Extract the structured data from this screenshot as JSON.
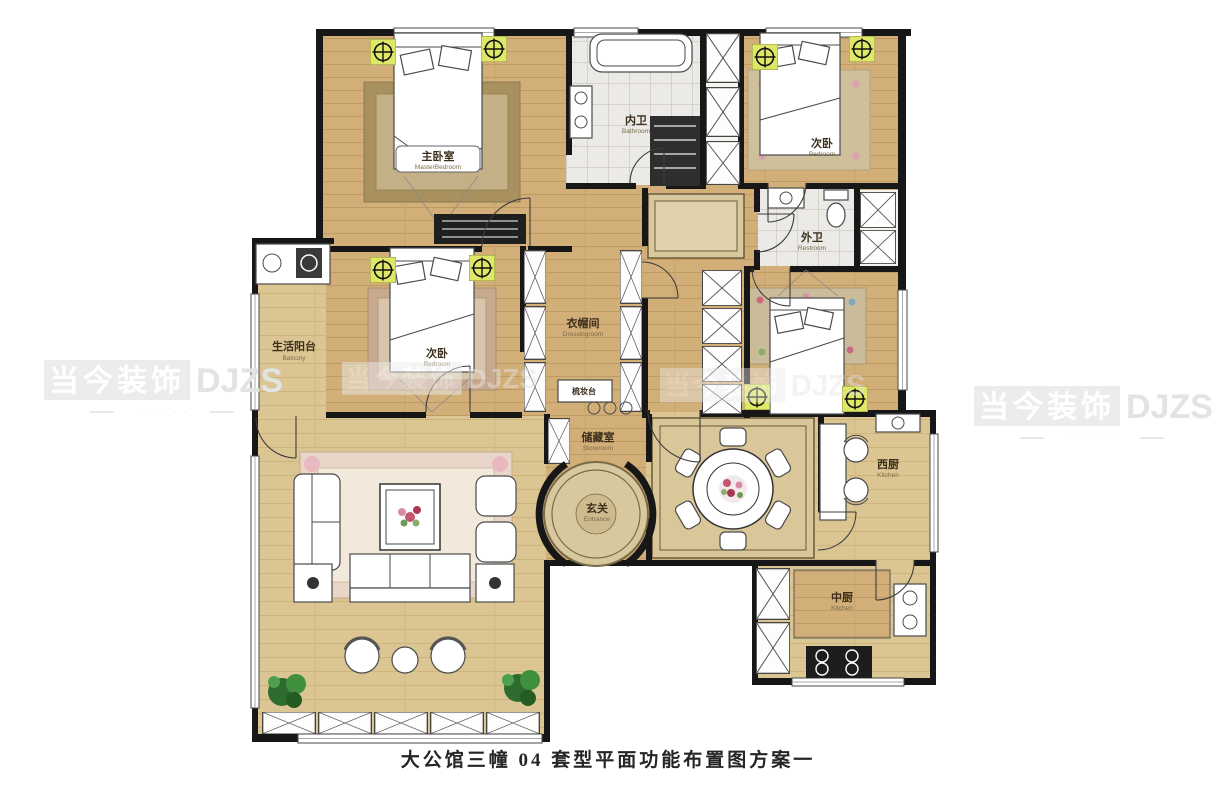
{
  "title": "大公馆三幢 04 套型平面功能布置图方案一",
  "watermark": {
    "brand_cn": "当今装饰",
    "brand_en": "DJZS",
    "tagline": "· · · · · ·"
  },
  "icons": {
    "ceiling_lamp_symbol": "⊕",
    "plant_symbol": "❃"
  },
  "rooms": {
    "master_bedroom": {
      "cn": "主卧室",
      "en": "MasterBedroom"
    },
    "inner_bath": {
      "cn": "内卫",
      "en": "Bathroom"
    },
    "bedroom_top_right": {
      "cn": "次卧",
      "en": "Bedroom"
    },
    "outer_bath": {
      "cn": "外卫",
      "en": "Restroom"
    },
    "balcony": {
      "cn": "生活阳台",
      "en": "Balcony"
    },
    "bedroom_middle": {
      "cn": "次卧",
      "en": "Bedroom"
    },
    "cloakroom": {
      "cn": "衣帽间",
      "en": "Dressingroom"
    },
    "dressing_table": {
      "cn": "梳妆台"
    },
    "storeroom": {
      "cn": "储藏室",
      "en": "Storeroom"
    },
    "entrance": {
      "cn": "玄关",
      "en": "Entrance"
    },
    "west_kitchen": {
      "cn": "西厨",
      "en": "Kitchen"
    },
    "chinese_kitchen": {
      "cn": "中厨",
      "en": "Kitchen"
    }
  }
}
